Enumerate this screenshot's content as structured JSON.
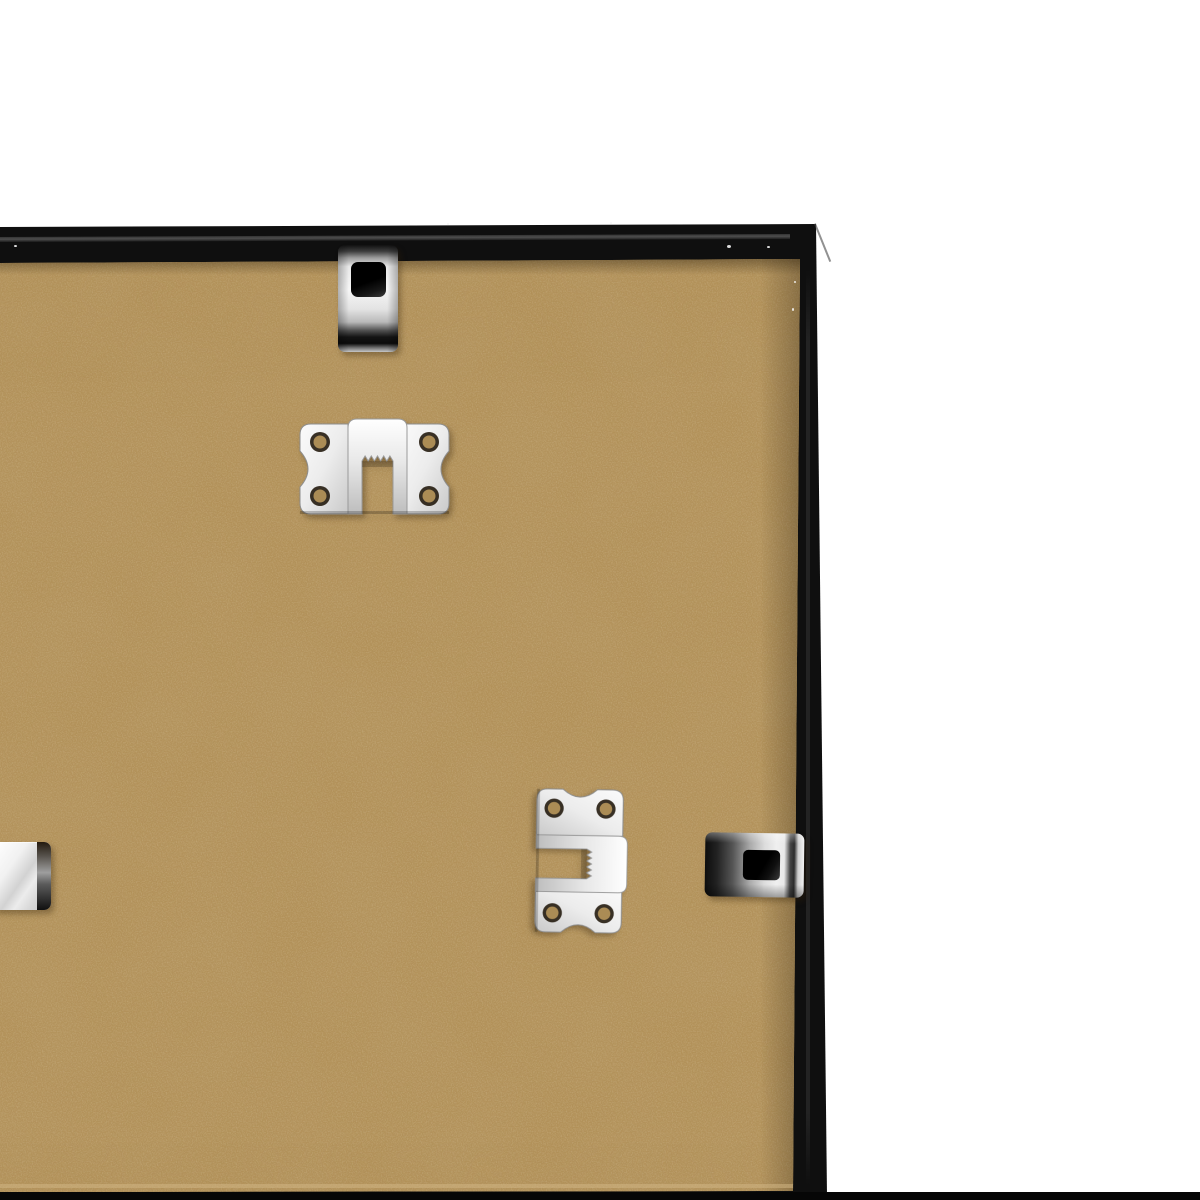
{
  "scene": {
    "subject": "Back of a black picture frame with MDF backing board and silver metal hanging hardware on a white background"
  },
  "colors": {
    "background": "#ffffff",
    "frame_black": "#0f0f0f",
    "band_sliver": "#2a2a2a",
    "mdf_base": "#b29159",
    "mdf_light_fleck": "#d9bf8e",
    "mdf_dark_fleck": "#77603a",
    "mdf_edge_light": "#cfb483",
    "metal_bright": "#f4f4f4",
    "metal_mid": "#aeaeae",
    "metal_dark": "#1c1c1c",
    "hole_black": "#0a0a0a",
    "hole_tan": "#ab8c55",
    "hole_ring": "#241b0e",
    "bottom_bar": "#060606",
    "speck": "#f4f4f4",
    "hw_shadow": "rgba(50,32,8,0.35)"
  },
  "objects": {
    "frame": "black frame back edge",
    "backing": "tan MDF backing board",
    "top_clip": "silver flexible turn clip on top edge",
    "top_hanger": "silver sawtooth hanger, horizontal",
    "side_hanger": "silver sawtooth hanger, rotated vertical",
    "side_clip": "silver flexible turn clip on right edge",
    "left_clip": "silver clip partially visible at left edge",
    "bottom_border": "black strip along bottom of photo"
  }
}
